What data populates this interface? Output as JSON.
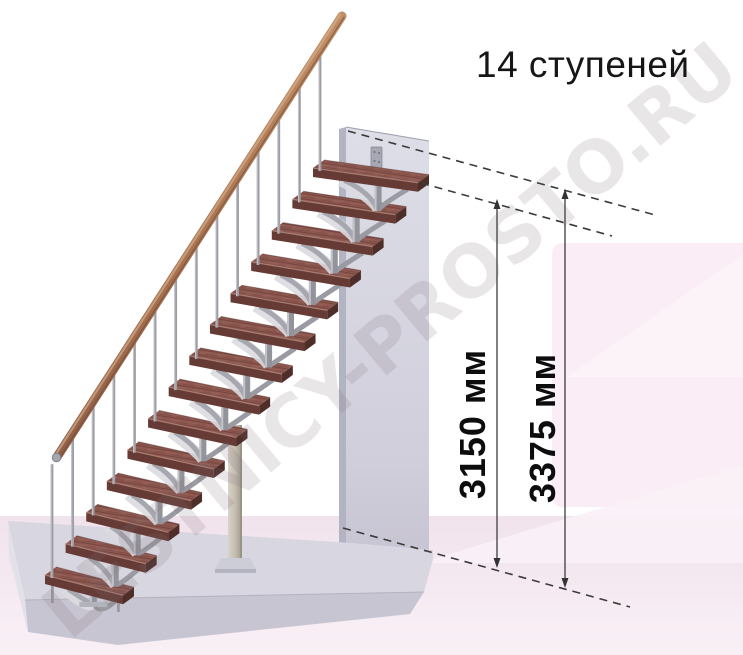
{
  "title": "14 ступеней",
  "watermark": {
    "text": "LESTNICY-PROSTO.RU"
  },
  "stairs": {
    "steps_count": 14
  },
  "dimensions": [
    {
      "label": "3150 мм",
      "value_mm": 3150
    },
    {
      "label": "3375 мм",
      "value_mm": 3375
    }
  ],
  "colors": {
    "tread_top": "#8c584f",
    "tread_front": "#663b35",
    "tread_side": "#4f2d28",
    "tread_edge_highlight": "#ab8075",
    "metal_light": "#c3c3c9",
    "metal": "#9a9aa2",
    "metal_dark": "#93939b",
    "handrail_dark": "#8f5f48",
    "handrail_light": "#c08e66",
    "wall_face": "#d6d7e1",
    "wall_edge": "#b3b4c2",
    "slab_top": "#d8d6e0",
    "slab_front": "#c8c5d2",
    "floor_pink": "#f1e3ec",
    "card_pink": "#faedf5",
    "annotation": "#3b3b3b",
    "text": "#111111"
  }
}
